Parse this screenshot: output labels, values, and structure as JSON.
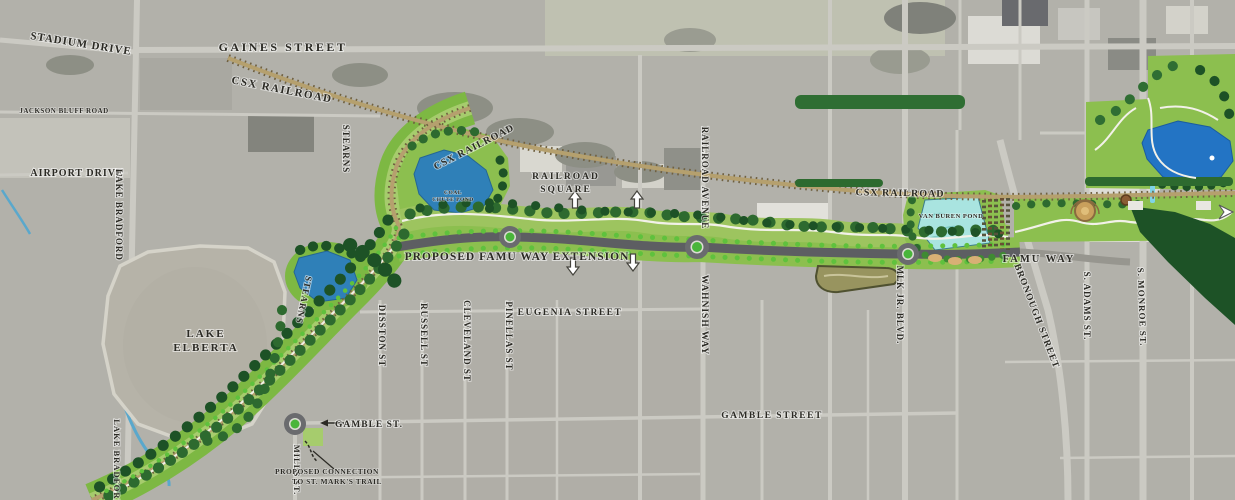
{
  "colors": {
    "aerial_gray": "#b2b1aa",
    "corridor_green": "#8cbf4f",
    "lawn_light_green": "#a6cc6d",
    "tree_dark_green": "#2d6a2f",
    "forest_green": "#1d5226",
    "street_tree_green": "#5fc13d",
    "pond_blue": "#2f80b8",
    "park_pond_blue": "#2374c4",
    "van_buren_cyan": "#a9e4e0",
    "railroad_tan": "#b5a06e",
    "railroad_tie_brown": "#6f6040",
    "road_gray": "#5d5e62",
    "label_ink": "#2b2a24"
  },
  "labels": {
    "stadium_drive": "STADIUM DRIVE",
    "gaines_street": "GAINES STREET",
    "csx_railroad": "CSX RAILROAD",
    "jackson_bluff_road": "JACKSON BLUFF ROAD",
    "airport_drive": "AIRPORT DRIVE",
    "lake_bradford": "LAKE BRADFORD",
    "stearns": "STEARNS",
    "railroad_square_line1": "RAILROAD",
    "railroad_square_line2": "SQUARE",
    "railroad_avenue": "RAILROAD AVENUE",
    "coal_chute_line1": "COAL",
    "coal_chute_line2": "CHUTE POND",
    "proposed_extension": "PROPOSED FAMU WAY EXTENSION",
    "lake_elberta_line1": "LAKE",
    "lake_elberta_line2": "ELBERTA",
    "disston_st": "DISSTON ST",
    "russell_st": "RUSSELL ST",
    "cleveland_st": "CLEVELAND ST",
    "pinellas_st": "PINELLAS ST",
    "eugenia_street": "EUGENIA STREET",
    "wahnish_way": "WAHNISH WAY",
    "gamble_street": "GAMBLE STREET",
    "mlk_jr_blvd": "MLK JR. BLVD.",
    "van_buren_pond": "VAN BUREN POND",
    "famu_way": "FAMU WAY",
    "bronough_street": "BRONOUGH STREET",
    "s_adams_st": "S. ADAMS ST.",
    "s_monroe_st": "S. MONROE ST.",
    "gamble_st_abbr": "GAMBLE ST.",
    "mills_st": "MILLS ST.",
    "connection_line1": "PROPOSED CONNECTION",
    "connection_line2": "TO ST. MARK'S TRAIL"
  }
}
